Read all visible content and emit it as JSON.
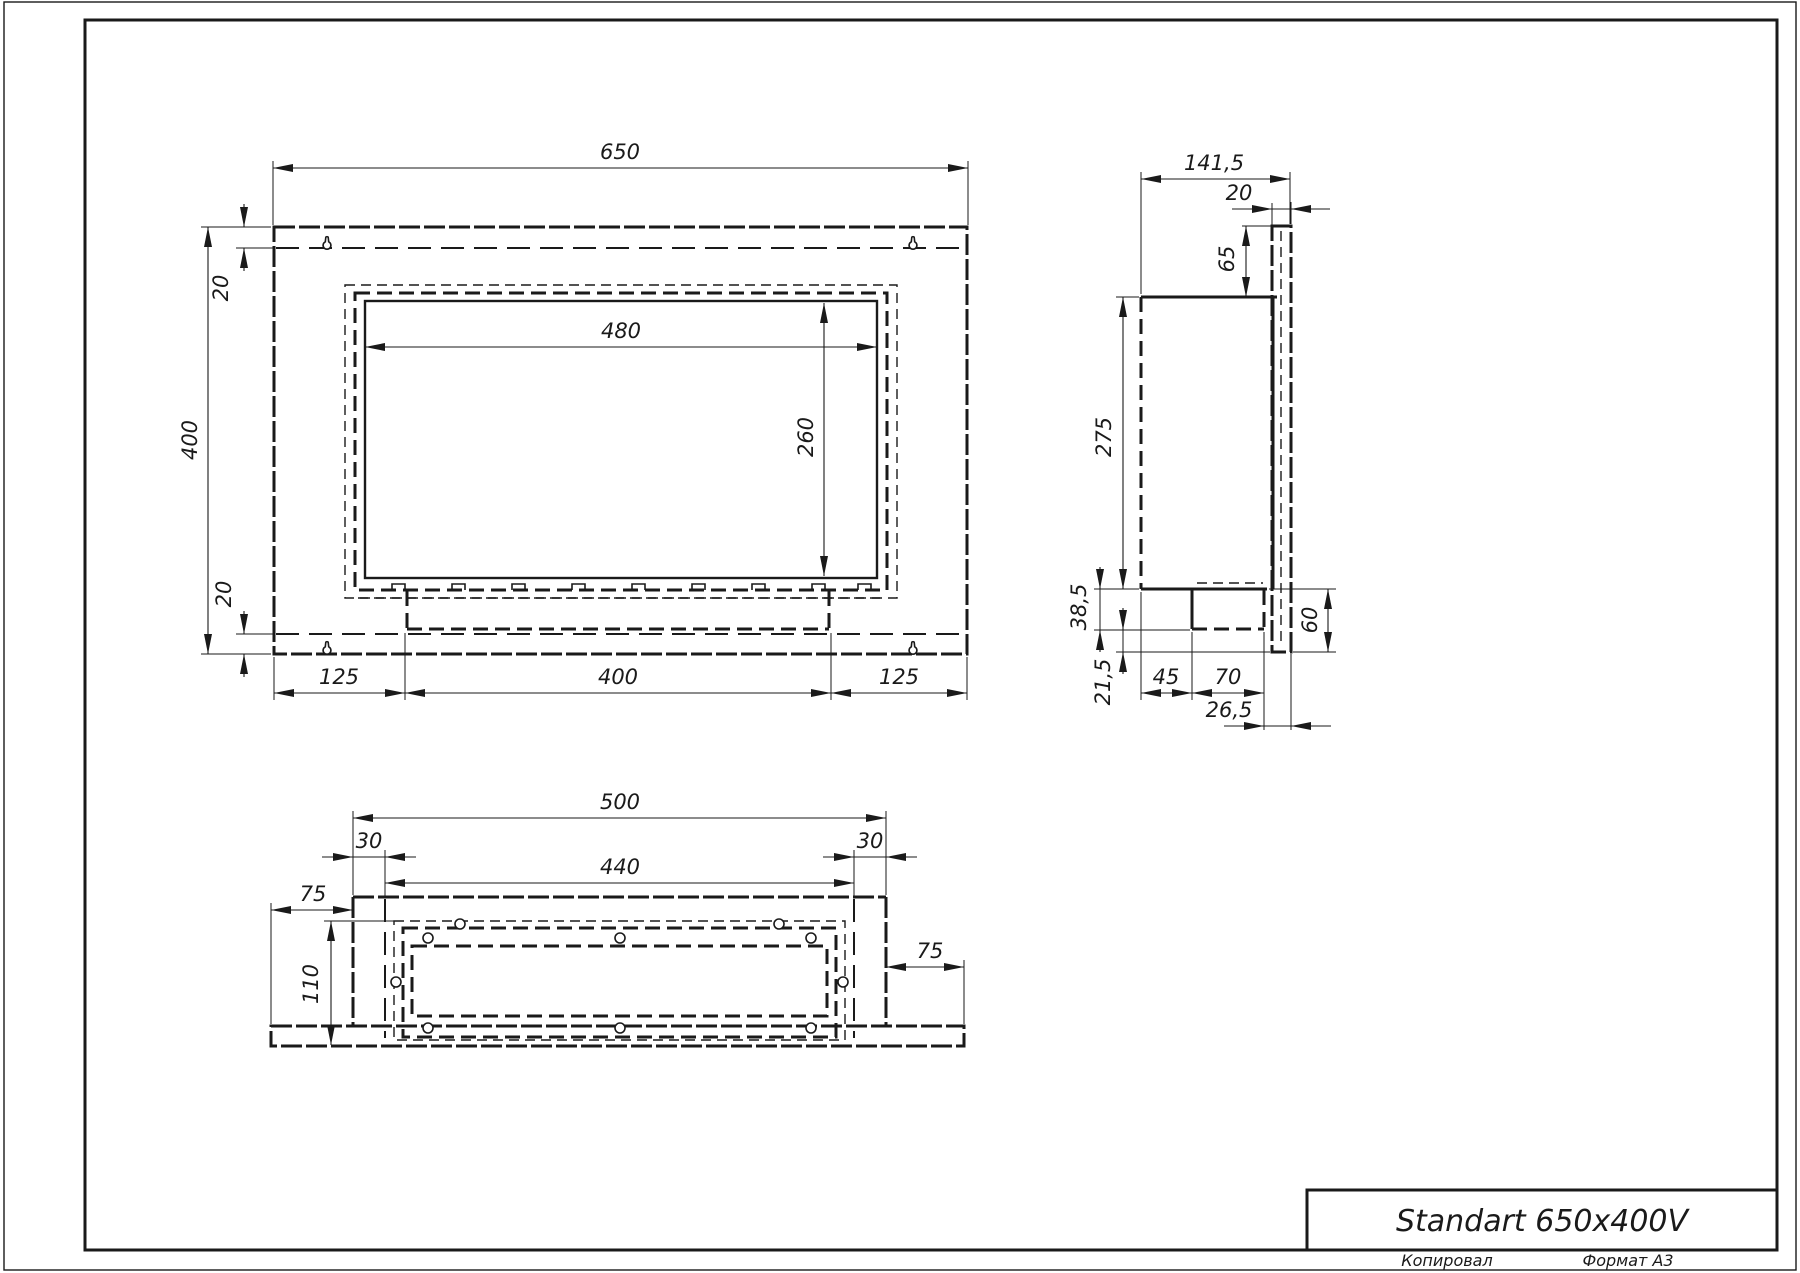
{
  "sheet": {
    "title": "Standart 650x400V",
    "copied_label": "Копировал",
    "format_label": "Формат А3"
  },
  "front_view": {
    "width": "650",
    "height": "400",
    "opening_width": "480",
    "opening_height": "260",
    "top_inset": "20",
    "bottom_inset": "20",
    "left_margin": "125",
    "burner_width": "400",
    "right_margin": "125"
  },
  "side_view": {
    "depth": "141,5",
    "flange_thickness": "20",
    "flange_top_offset": "65",
    "body_height": "275",
    "tray_depth": "38,5",
    "flange_bottom_gap": "21,5",
    "tray_back_offset": "45",
    "tray_width": "70",
    "tray_front_offset": "26,5",
    "flange_bottom_drop": "60"
  },
  "bottom_view": {
    "body_width": "500",
    "left_inset": "30",
    "opening_width": "440",
    "right_inset": "30",
    "left_flange": "75",
    "depth": "110",
    "right_flange": "75"
  }
}
